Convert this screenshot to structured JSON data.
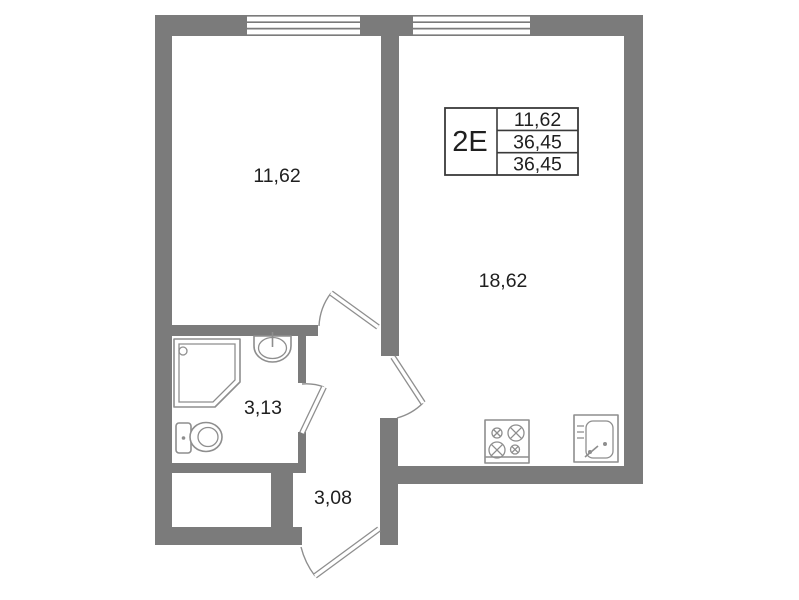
{
  "plan": {
    "unit": {
      "label": "2Е"
    },
    "info_box": {
      "rows": [
        "11,62",
        "36,45",
        "36,45"
      ]
    },
    "rooms": {
      "living": {
        "area": "11,62"
      },
      "kitchen_living": {
        "area": "18,62"
      },
      "bathroom": {
        "area": "3,13"
      },
      "hallway": {
        "area": "3,08"
      }
    },
    "colors": {
      "wall": "#7b7b7b",
      "fixture_line": "#8e8e8e",
      "text": "#1f1f1f",
      "box_line": "#3a3a3a",
      "background": "#ffffff"
    }
  }
}
